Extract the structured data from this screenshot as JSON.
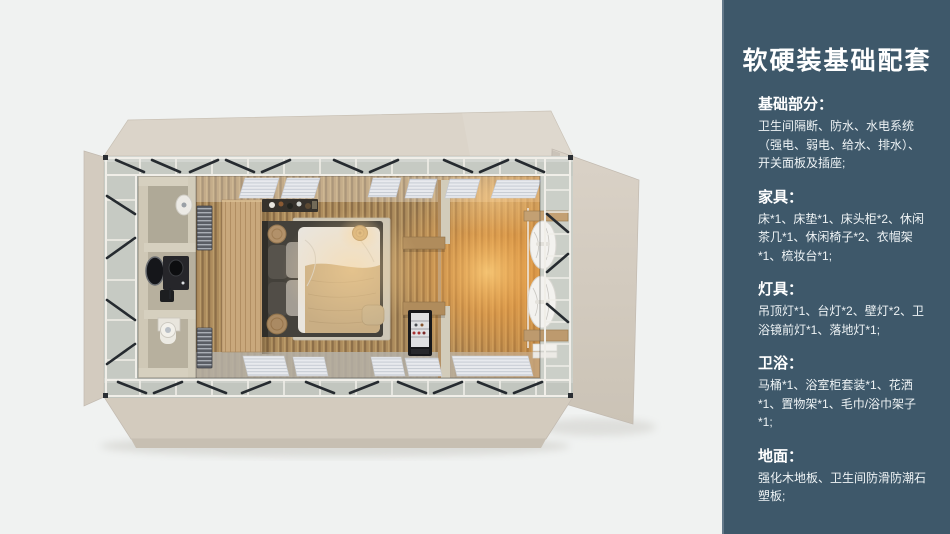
{
  "panel": {
    "title": "软硬装基础配套",
    "background_color": "#3e586a",
    "text_color": "#ffffff",
    "sections": [
      {
        "heading": "基础部分：",
        "body": "卫生间隔断、防水、水电系统（强电、弱电、给水、排水）、开关面板及插座;"
      },
      {
        "heading": "家具：",
        "body": "床*1、床垫*1、床头柜*2、休闲茶几*1、休闲椅子*2、衣帽架*1、梳妆台*1;"
      },
      {
        "heading": "灯具：",
        "body": "吊顶灯*1、台灯*2、壁灯*2、卫浴镜前灯*1、落地灯*1;"
      },
      {
        "heading": "卫浴：",
        "body": "马桶*1、浴室柜套装*1、花洒*1、置物架*1、毛巾/浴巾架子*1;"
      },
      {
        "heading": "地面：",
        "body": "强化木地板、卫生间防滑防潮石塑板;"
      }
    ]
  },
  "render": {
    "type": "3d-top-view-floorplan",
    "subject": "prefab bedroom unit with bathroom, bed, wardrobe partition and lit lounge corner",
    "background_color": "#f0f2f1",
    "wood_floor_color": "#ad8c5d",
    "flap_color": "#d8d0c5",
    "glow_color": "#ffac50",
    "items": [
      "bathroom",
      "vanity-mirror",
      "toilet",
      "shower",
      "towel-radiator",
      "wardrobe-partition",
      "clothes-rack",
      "bed",
      "pillows",
      "rug",
      "bedside-stool",
      "floor-lamp",
      "wall-shelf",
      "mini-fridge",
      "window-blinds",
      "curtains",
      "steel-frame"
    ]
  }
}
